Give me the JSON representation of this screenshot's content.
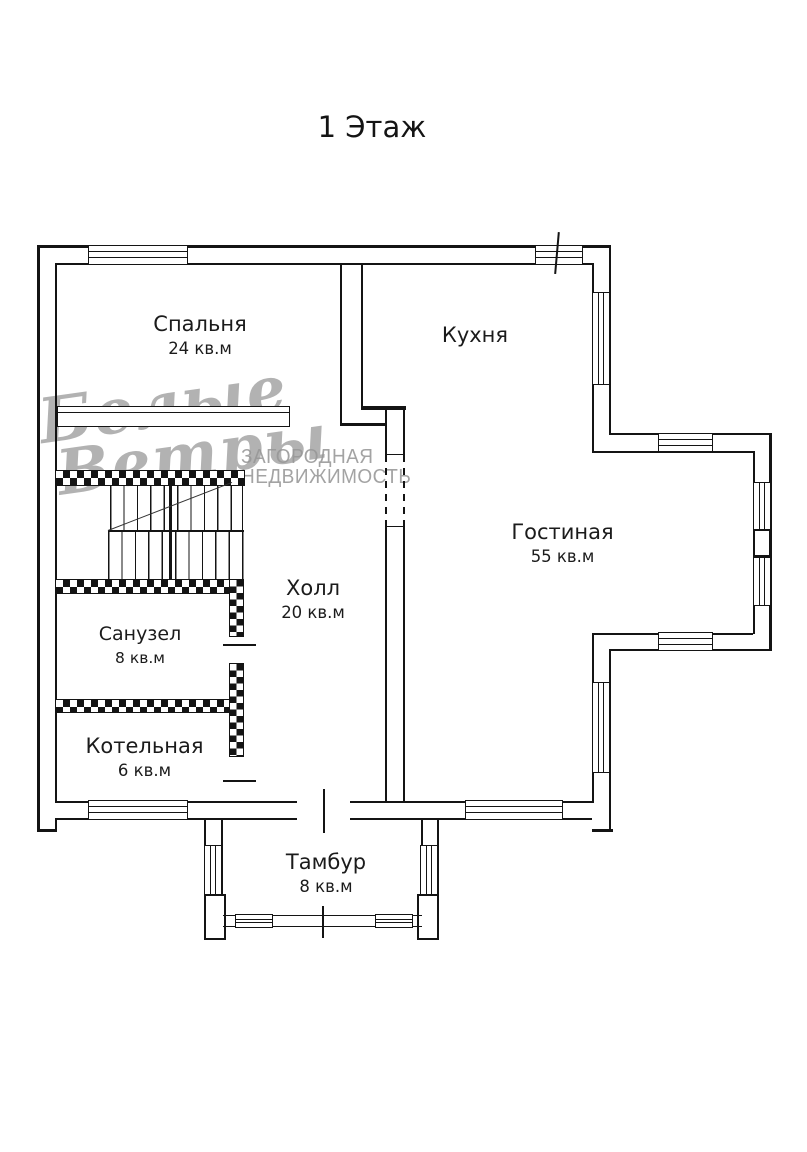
{
  "title": "1 Этаж",
  "rooms": [
    {
      "name": "Спальня",
      "area": "24 кв.м"
    },
    {
      "name": "Кухня",
      "area": ""
    },
    {
      "name": "Гостиная",
      "area": "55 кв.м"
    },
    {
      "name": "Холл",
      "area": "20 кв.м"
    },
    {
      "name": "Санузел",
      "area": "8 кв.м"
    },
    {
      "name": "Котельная",
      "area": "6 кв.м"
    },
    {
      "name": "Тамбур",
      "area": "8 кв.м"
    }
  ],
  "watermark": {
    "script_word1": "Белые",
    "script_word2": "Ветры",
    "tagline_line1": "ЗАГОРОДНАЯ",
    "tagline_line2": "НЕДВИЖИМОСТЬ"
  },
  "colors": {
    "line": "#141414",
    "text": "#1b1b1b",
    "watermark": "#969696",
    "background": "#ffffff"
  }
}
